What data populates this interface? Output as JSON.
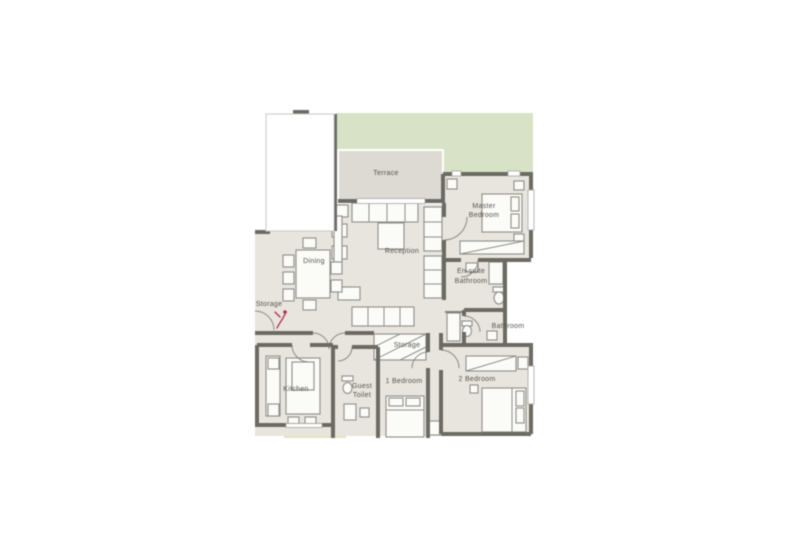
{
  "floorplan": {
    "colors": {
      "background": "#ffffff",
      "floor": "#e8e5de",
      "terrace_floor": "#dcdad3",
      "wall": "#6b6a63",
      "furniture_fill": "#fbfbf8",
      "furniture_stroke": "#8f8e88",
      "garden": "#d8e2c6",
      "garden_strip": "#dce4c3",
      "label": "#54524c",
      "marker": "#b52e4f",
      "window": "#a7a6a0",
      "overlay_border": "#c9c9c7"
    },
    "rooms": {
      "terrace": "Terrace",
      "master_bedroom_line1": "Master",
      "master_bedroom_line2": "Bedroom",
      "reception": "Reception",
      "dining": "Dining",
      "storage_left": "Storage",
      "ensuite_line1": "En-suite",
      "ensuite_line2": "Bathroom",
      "bathroom": "Bathroom",
      "storage_center": "Storage",
      "kitchen": "Kitchen",
      "guest_toilet_line1": "Guest",
      "guest_toilet_line2": "Toilet",
      "bedroom_1": "1 Bedroom",
      "bedroom_2": "2 Bedroom"
    }
  }
}
